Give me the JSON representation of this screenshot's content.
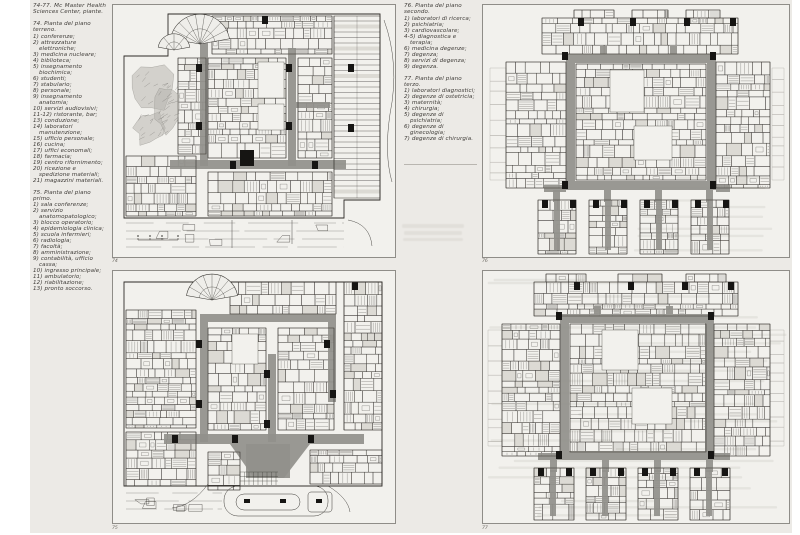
{
  "publication": {
    "header_caption": "74-77. Mc Master Health Sciences Center, piante."
  },
  "left_column": {
    "sections": [
      {
        "title": "74. Pianta del piano terreno.",
        "items": [
          "1) conferenze;",
          "2) attrezzature elettroniche;",
          "3) medicina nucleare;",
          "4) biblioteca;",
          "5) insegnamento biochimica;",
          "6) studenti;",
          "7) stabulario;",
          "8) personale;",
          "9) insegnamento anatomia;",
          "10) servizi audiovisivi;",
          "11-12) ristorante, bar;",
          "13) conduzione;",
          "14) laboratori manutenzione;",
          "15) ufficio personale;",
          "16) cucina;",
          "17) uffici economali;",
          "18) farmacia;",
          "19) centro rifornimento;",
          "20) ricezione e spedizione materiali;",
          "21) magazzini materiali."
        ]
      },
      {
        "title": "75. Pianta del piano primo.",
        "items": [
          "1) sala conferenze;",
          "2) servizio anatomopatologico;",
          "3) blocco operatorio;",
          "4) epidemiologia clinica;",
          "5) scuola infermieri;",
          "6) radiologia;",
          "7) facoltà;",
          "8) amministrazione;",
          "9) contabilità, ufficio cassa;",
          "10) ingresso principale;",
          "11) ambulatorio;",
          "12) riabilitazione;",
          "13) pronto soccorso."
        ]
      }
    ]
  },
  "right_column": {
    "sections": [
      {
        "title": "76. Pianta del piano secondo.",
        "items": [
          "1) laboratori di ricerca;",
          "2) psichiatria;",
          "3) cardiovascolare;",
          "4-5) diagnostica e terapia;",
          "6) medicina degenze;",
          "7) degenza;",
          "8) servizi di degenza;",
          "9) degenza."
        ]
      },
      {
        "title": "77. Pianta del piano terzo.",
        "items": [
          "1) laboratori diagnostici;",
          "2) degenze di ostetricia;",
          "3) maternità;",
          "4) chirurgia;",
          "5) degenze di psichiatria;",
          "6) degenze di ginecologia;",
          "7) degenze di chirurgia."
        ]
      }
    ]
  },
  "figures": {
    "fig74": {
      "label": "74"
    },
    "fig75": {
      "label": "75"
    },
    "fig76": {
      "label": "76"
    },
    "fig77": {
      "label": "77"
    }
  },
  "colors": {
    "page_bg": "#ECEAE6",
    "plan_bg": "#F2F1ED",
    "frame": "#8F8D88",
    "corridor": "#91908B",
    "ink": "#3B3935",
    "core": "#161513",
    "fill_cell": "#DCDAD4",
    "ghost": "#DBD9D3"
  }
}
